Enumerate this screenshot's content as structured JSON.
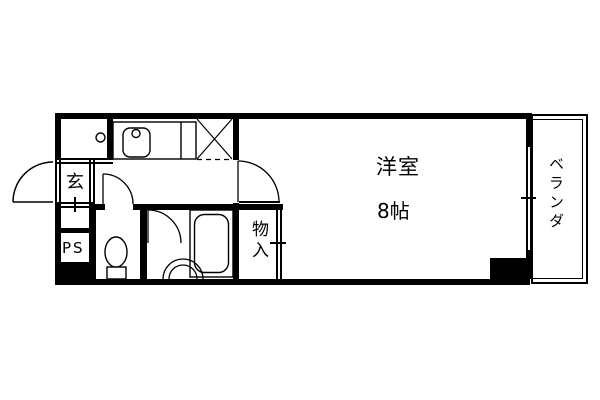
{
  "diagram_type": "japanese-apartment-floor-plan",
  "labels": {
    "entrance": "玄",
    "pipe_space": "PS",
    "storage": "物入",
    "main_room": "洋室",
    "main_room_size": "8帖",
    "balcony": "ベランダ"
  },
  "fixtures": [
    "kitchen-sink",
    "refrigerator-space",
    "toilet",
    "bathtub",
    "washbasin",
    "entrance-door-swing",
    "hallway-door-swing",
    "bathroom-door-swing",
    "main-room-door-swing",
    "balcony-window",
    "closet-sliding-door"
  ],
  "colors": {
    "wall": "#000000",
    "background": "#ffffff",
    "line": "#000000"
  }
}
